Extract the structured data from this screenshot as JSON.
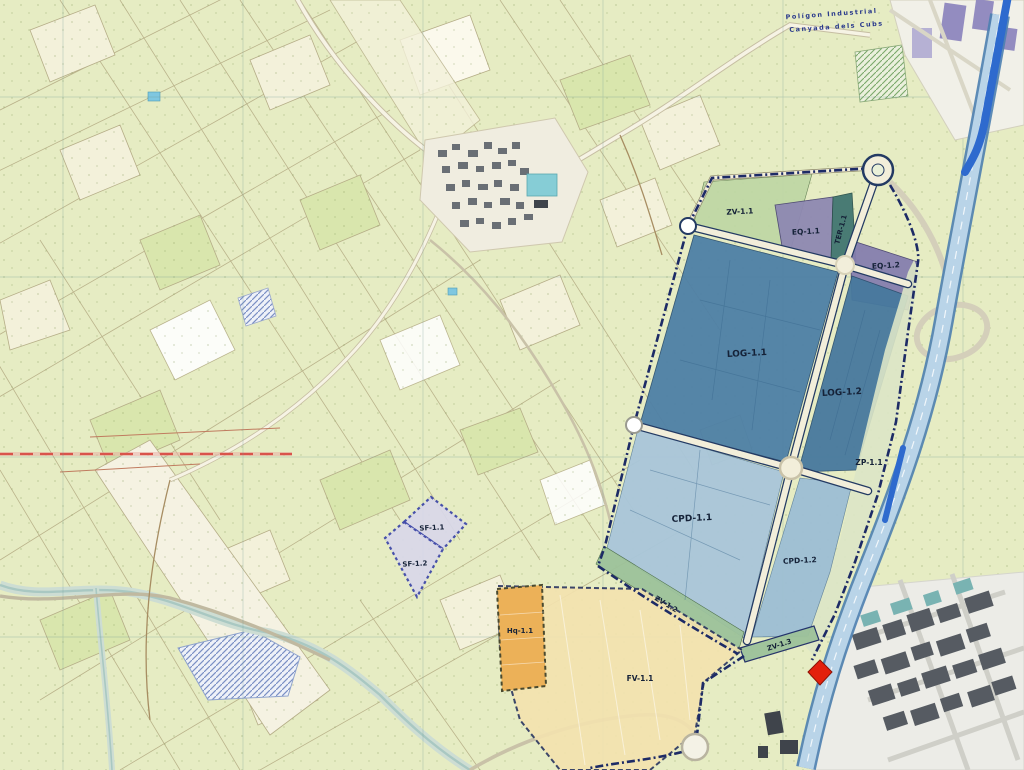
{
  "map": {
    "title": "Cadastral zoning plan overlay map",
    "region_labels": {
      "industrial_estate_line1": "Polígon Industrial",
      "industrial_estate_line2": "Canyada dels Cubs"
    },
    "zones": [
      {
        "id": "ZV-1.1",
        "label": "ZV-1.1",
        "color": "#bed7a4"
      },
      {
        "id": "EQ-1.1",
        "label": "EQ-1.1",
        "color": "#8e88b2"
      },
      {
        "id": "TER-1.1",
        "label": "TER-1.1",
        "color": "#417670"
      },
      {
        "id": "EQ-1.2",
        "label": "EQ-1.2",
        "color": "#867fae"
      },
      {
        "id": "LOG-1.1",
        "label": "LOG-1.1",
        "color": "#4e80a6"
      },
      {
        "id": "LOG-1.2",
        "label": "LOG-1.2",
        "color": "#47799e"
      },
      {
        "id": "ZP-1.1",
        "label": "ZP-1.1",
        "color": "#dbe6c6"
      },
      {
        "id": "CPD-1.1",
        "label": "CPD-1.1",
        "color": "#a9c6da"
      },
      {
        "id": "CPD-1.2",
        "label": "CPD-1.2",
        "color": "#9dbed4"
      },
      {
        "id": "ZV-1.2",
        "label": "ZV-1.2",
        "color": "#9dc29a"
      },
      {
        "id": "ZV-1.3",
        "label": "ZV-1.3",
        "color": "#9dc29a"
      },
      {
        "id": "FV-1.1",
        "label": "FV-1.1",
        "color": "#f4e3af"
      },
      {
        "id": "Hq-1.1",
        "label": "Hq-1.1",
        "color": "#ecb158"
      },
      {
        "id": "SF-1.1",
        "label": "SF-1.1",
        "color": "#d9d8ea"
      },
      {
        "id": "SF-1.2",
        "label": "SF-1.2",
        "color": "#d9d8ea"
      }
    ],
    "markers": [
      {
        "id": "location-diamond",
        "color": "#e3200c"
      }
    ],
    "colors": {
      "base": "#e6ecc3",
      "boundary": "#1d2b66",
      "plan_road_fill": "#f2eeda",
      "plan_road_edge": "#233a63",
      "motorway_band": "#b9d4e8",
      "motorway_edge": "#4d7fb0",
      "blue_road": "#2e6ace",
      "red_line": "#d9544b"
    }
  }
}
